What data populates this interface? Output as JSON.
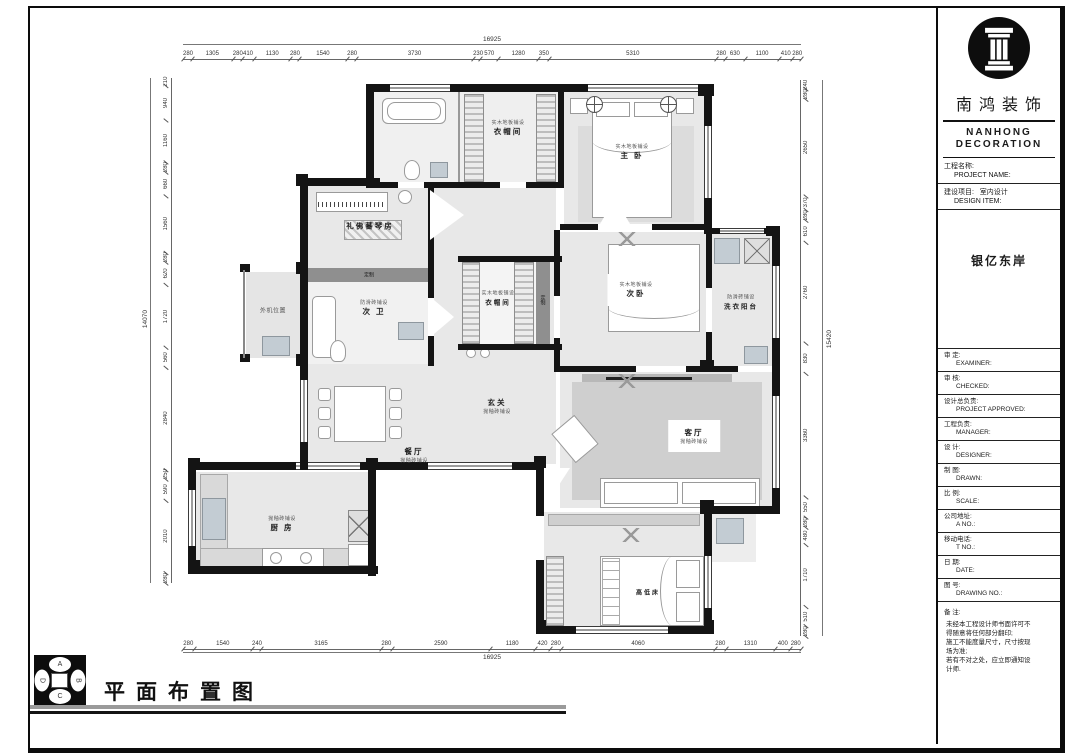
{
  "title_block": {
    "brand_cn": "南鸿装饰",
    "brand_en": "NANHONG DECORATION",
    "project_label_cn": "工程名称:",
    "project_label_en": "PROJECT NAME:",
    "item_label_cn": "建设项目:",
    "item_value": "室内设计",
    "item_label_en": "DESIGN ITEM:",
    "project_name": "银亿东岸",
    "rows": [
      {
        "cn": "审  定:",
        "en": "EXAMINER:"
      },
      {
        "cn": "审  核:",
        "en": "CHECKED:"
      },
      {
        "cn": "设计总负责:",
        "en": "PROJECT APPROVED:"
      },
      {
        "cn": "工程负责:",
        "en": "MANAGER:"
      },
      {
        "cn": "设  计:",
        "en": "DESIGNER:"
      },
      {
        "cn": "制  图:",
        "en": "DRAWN:"
      },
      {
        "cn": "比  例:",
        "en": "SCALE:"
      },
      {
        "cn": "公司地址:",
        "en": "A  NO.:"
      },
      {
        "cn": "移动电话:",
        "en": "T  NO.:"
      },
      {
        "cn": "日  期:",
        "en": "DATE:"
      },
      {
        "cn": "图  号:",
        "en": "DRAWING NO.:"
      }
    ],
    "notes_label": "备  注:",
    "notes": [
      "未经本工程设计师书面许可不",
      "得随意将任何部分翻印;",
      "施工不能度量尺寸，尺寸按现",
      "场为准;",
      "若有不对之处，应立即通知设",
      "计师."
    ]
  },
  "plan": {
    "rooms": {
      "closet1": {
        "sub": "实木地板铺设",
        "name": "衣帽间"
      },
      "master": {
        "sub": "实木地板铺设",
        "name": "主 卧"
      },
      "piano": {
        "name": "礼佛蕃琴房"
      },
      "custom1": "定制",
      "custom2": "定制",
      "bath2": {
        "sub": "防滑砖铺设",
        "name": "次 卫"
      },
      "outdoor": {
        "name": "外机位置"
      },
      "closet2": {
        "sub": "实木地板铺设",
        "name": "衣帽间"
      },
      "bedroom2": {
        "sub": "实木地板铺设",
        "name": "次卧"
      },
      "laundry": {
        "sub": "防滑砖铺设",
        "name": "洗衣阳台"
      },
      "hall": {
        "name": "玄关",
        "sub": "抛釉砖铺设"
      },
      "dining": {
        "name": "餐厅",
        "sub": "抛釉砖铺设"
      },
      "living": {
        "name": "客厅",
        "sub": "抛釉砖铺设"
      },
      "kitchen": {
        "sub": "抛釉砖铺设",
        "name": "厨 房"
      },
      "kids_bed": "高低床"
    },
    "dims": {
      "top": [
        "280",
        "1305",
        "280",
        "410",
        "1130",
        "280",
        "1540",
        "280",
        "3730",
        "230",
        "570",
        "1280",
        "350",
        "5310",
        "280",
        "630",
        "1100",
        "410",
        "280"
      ],
      "top_total": "16925",
      "bottom": [
        "280",
        "1540",
        "240",
        "3165",
        "280",
        "2590",
        "1180",
        "420",
        "280",
        "4060",
        "280",
        "1310",
        "400",
        "280"
      ],
      "bottom_total": "16925",
      "left": [
        "210",
        "940",
        "1160",
        "280",
        "660",
        "1560",
        "280",
        "620",
        "1720",
        "560",
        "2840",
        "250",
        "590",
        "2010",
        "280"
      ],
      "left_total": "14070",
      "right": [
        "240",
        "280",
        "2650",
        "370",
        "280",
        "610",
        "2760",
        "830",
        "3360",
        "550",
        "280",
        "480",
        "1710",
        "510",
        "280"
      ],
      "right_total": "15420"
    }
  },
  "footer": {
    "title": "平面布置图",
    "compass": {
      "top": "A",
      "right": "B",
      "bottom": "C",
      "left": "D"
    }
  }
}
